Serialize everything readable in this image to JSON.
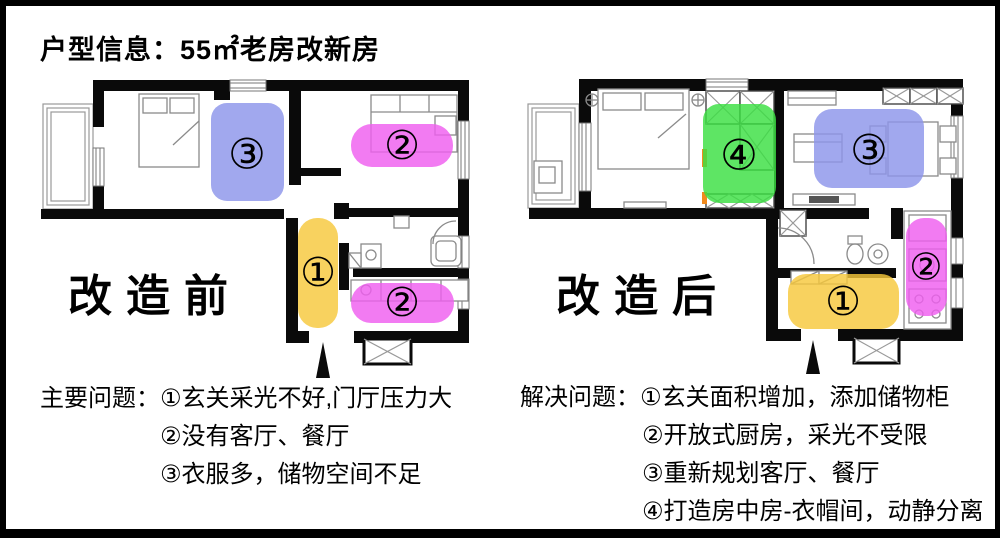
{
  "title": "户型信息：55㎡老房改新房",
  "colors": {
    "yellow": "#F7C83C",
    "magenta": "#EF5EEF",
    "blue": "#8C95EA",
    "green": "#3BDF42",
    "orange": "#F08A1E"
  },
  "before": {
    "label": "改造前",
    "marker_1": "①",
    "marker_2_top": "②",
    "marker_2_bottom": "②",
    "marker_3": "③"
  },
  "after": {
    "label": "改造后",
    "marker_1": "①",
    "marker_2": "②",
    "marker_3": "③",
    "marker_4": "④"
  },
  "problems": {
    "heading": "主要问题：",
    "line_1": "①玄关采光不好,门厅压力大",
    "line_2": "②没有客厅、餐厅",
    "line_3": "③衣服多，储物空间不足"
  },
  "solutions": {
    "heading": "解决问题：",
    "line_1": "①玄关面积增加，添加储物柜",
    "line_2": "②开放式厨房，采光不受限",
    "line_3": "③重新规划客厅、餐厅",
    "line_4": "④打造房中房-衣帽间，动静分离"
  }
}
